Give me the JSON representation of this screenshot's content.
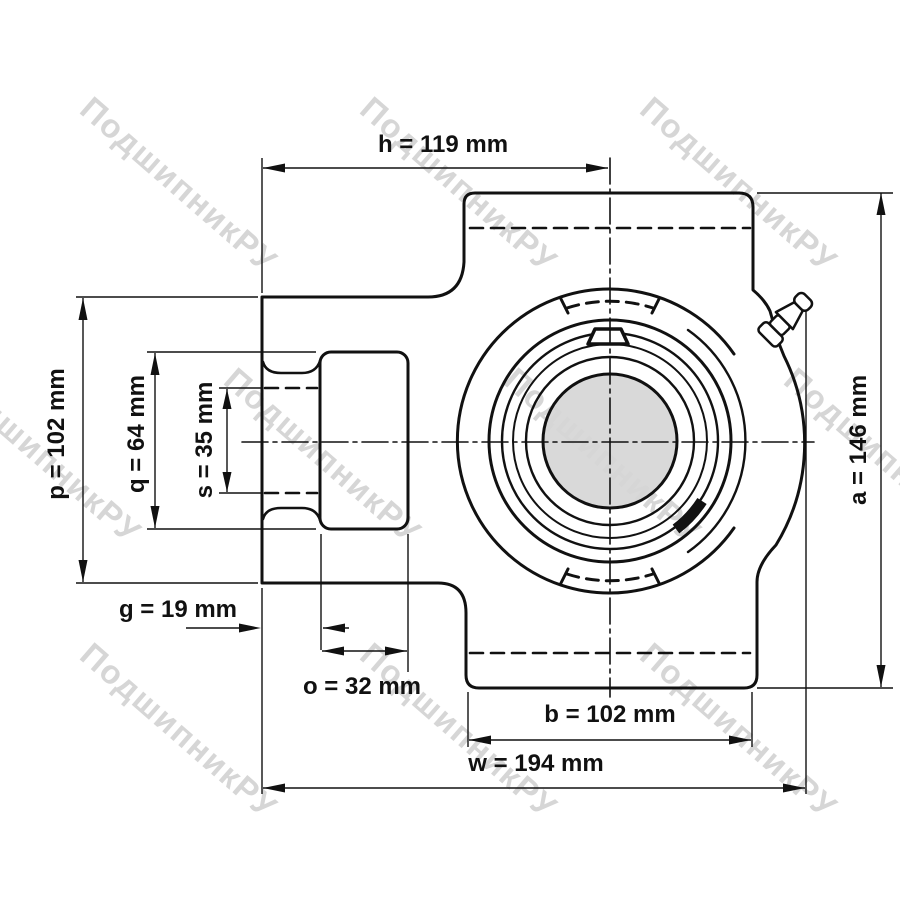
{
  "title": "Take-up bearing unit dimensional drawing",
  "watermark": {
    "text": "ПодшипникРУ",
    "color": "#d6d6d6"
  },
  "colors": {
    "line": "#111111",
    "shaft_fill": "#d9d9d9",
    "background": "#ffffff"
  },
  "dims": {
    "h": {
      "label": "h = 119 mm",
      "name": "h",
      "value": 119,
      "unit": "mm",
      "orientation": "horizontal"
    },
    "p": {
      "label": "p = 102 mm",
      "name": "p",
      "value": 102,
      "unit": "mm",
      "orientation": "vertical"
    },
    "q": {
      "label": "q = 64 mm",
      "name": "q",
      "value": 64,
      "unit": "mm",
      "orientation": "vertical"
    },
    "s": {
      "label": "s = 35 mm",
      "name": "s",
      "value": 35,
      "unit": "mm",
      "orientation": "vertical"
    },
    "g": {
      "label": "g = 19 mm",
      "name": "g",
      "value": 19,
      "unit": "mm",
      "orientation": "horizontal"
    },
    "o": {
      "label": "o = 32 mm",
      "name": "o",
      "value": 32,
      "unit": "mm",
      "orientation": "horizontal"
    },
    "b": {
      "label": "b = 102 mm",
      "name": "b",
      "value": 102,
      "unit": "mm",
      "orientation": "horizontal"
    },
    "w": {
      "label": "w = 194 mm",
      "name": "w",
      "value": 194,
      "unit": "mm",
      "orientation": "horizontal"
    },
    "a": {
      "label": "a = 146 mm",
      "name": "a",
      "value": 146,
      "unit": "mm",
      "orientation": "vertical"
    }
  }
}
